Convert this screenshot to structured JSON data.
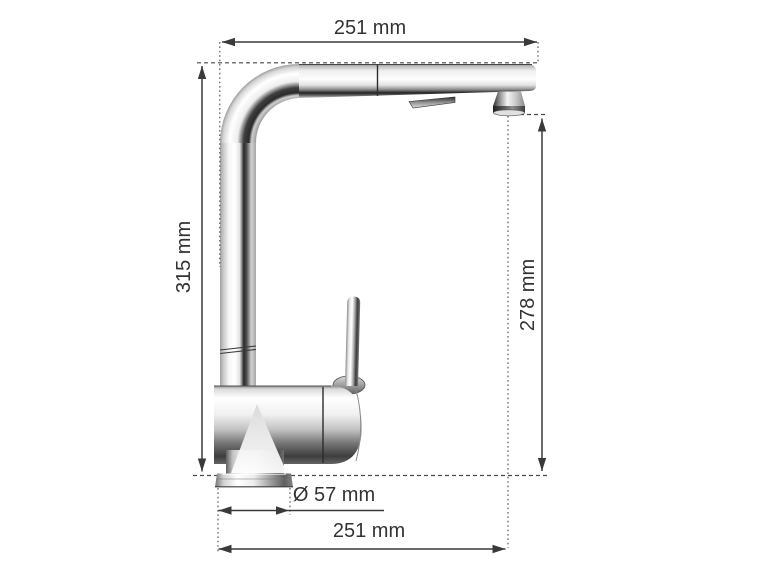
{
  "diagram": {
    "subject": "kitchen-faucet-side-view-dimension-drawing",
    "faucet_finish": "chrome",
    "labels": {
      "top_width": "251 mm",
      "total_height": "315 mm",
      "spout_height": "278 mm",
      "base_diameter": "Ø 57 mm",
      "bottom_reach": "251 mm"
    },
    "colors": {
      "background": "#ffffff",
      "dimension_line": "#3a3a3a",
      "guide_line": "#555555",
      "text": "#333333"
    }
  }
}
